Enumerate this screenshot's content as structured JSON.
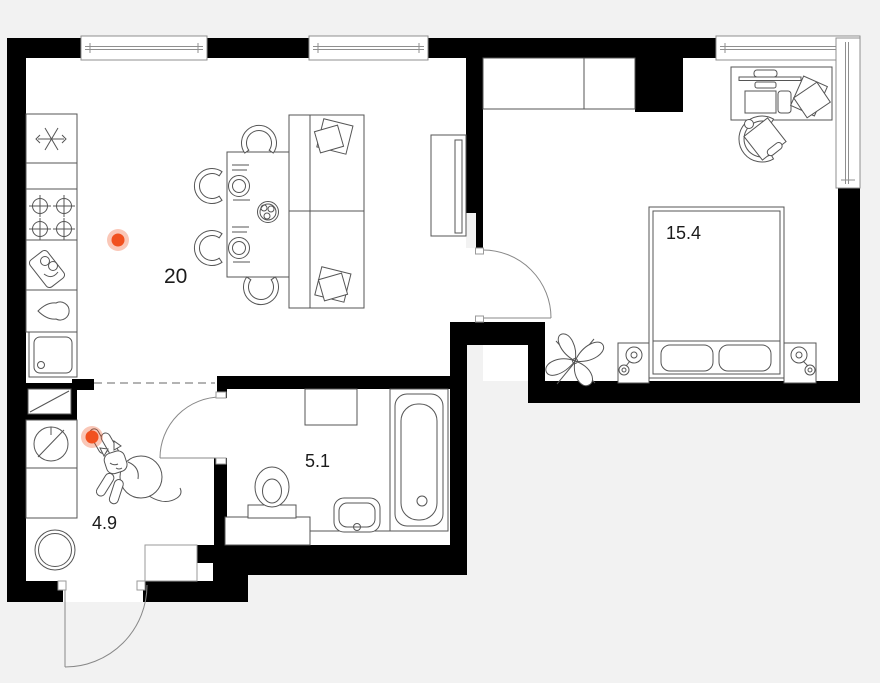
{
  "title": "apartment-floor-plan",
  "colors": {
    "background": "#f2f2f2",
    "floor": "#ffffff",
    "walls": "#000000",
    "furniture_line": "#555555",
    "window_line": "#8f8f8f",
    "door_line": "#888888",
    "accent": "#f1511f",
    "accent_halo": "rgba(241,81,31,0.32)",
    "label_text": "#1b1b1b"
  },
  "rooms": [
    {
      "id": "living-kitchen",
      "area": "20"
    },
    {
      "id": "bedroom",
      "area": "15.4"
    },
    {
      "id": "bathroom",
      "area": "5.1"
    },
    {
      "id": "hallway",
      "area": "4.9"
    }
  ],
  "markers": [
    {
      "id": "point-living",
      "transform": "translate(118,240)"
    },
    {
      "id": "point-hallway",
      "transform": "translate(92,437)"
    }
  ],
  "icons": {
    "fridge-icon": "snowflake",
    "stove-icon": "four-burners",
    "cutting-board-icon": "tilted-board",
    "kettle-icon": "teardrop",
    "kitchen-sink-icon": "rounded-basin",
    "vent-shaft-icon": "rect-with-diagonal",
    "washing-machine-icon": "crossed-circle",
    "water-heater-icon": "double-circle",
    "dining-table-icon": "table-with-plates",
    "chair-icon": "horseshoe-arc",
    "sofa-icon": "two-seat-sofa-with-pillows",
    "tv-console-icon": "console-with-panel",
    "wardrobe-icon": "divided-rect",
    "desk-icon": "desk-with-monitor-and-papers",
    "office-chair-icon": "arc-with-seat",
    "bed-icon": "bed-with-two-pillows",
    "nightstand-lamp-icon": "square-with-lamp",
    "plant-icon": "leaf-rosette",
    "toilet-icon": "bowl-with-tank",
    "washbasin-icon": "rounded-sink",
    "bathtub-icon": "tub-with-drain",
    "cat-icon": "line-drawn-cat",
    "window-icon": "double-glazing-band",
    "door-arc-icon": "quarter-circle-swing"
  }
}
